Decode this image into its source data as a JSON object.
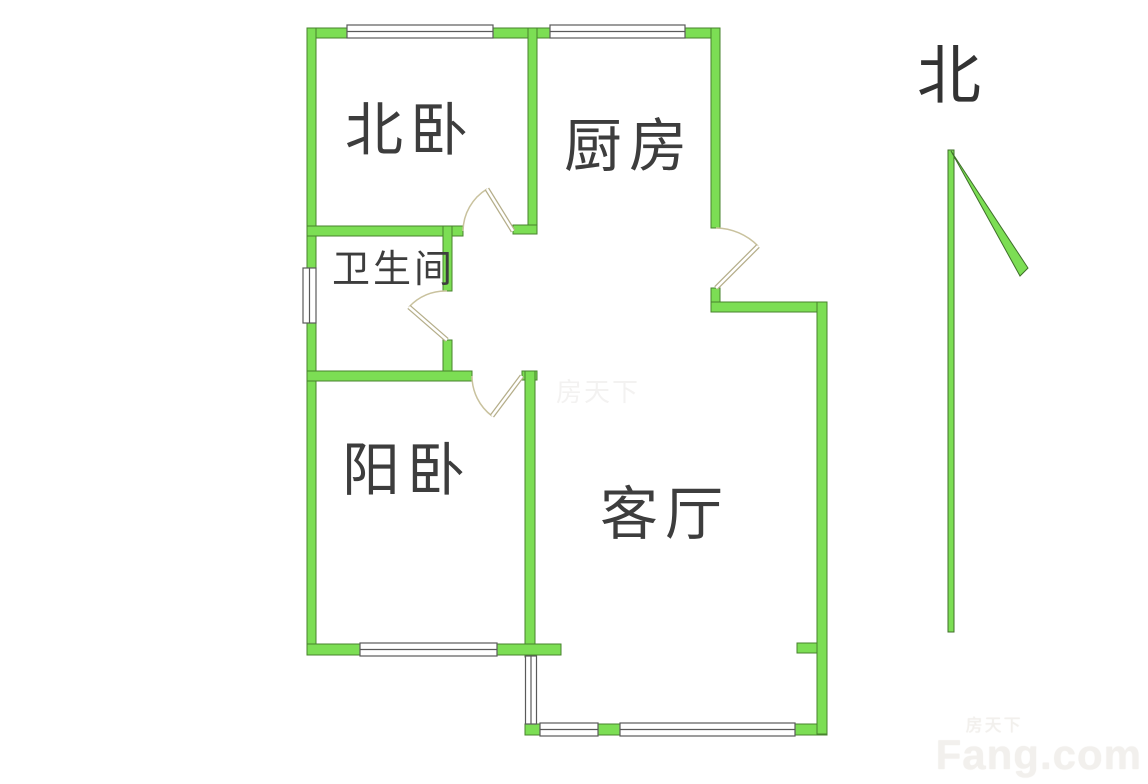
{
  "page": {
    "background": "#ffffff"
  },
  "colors": {
    "wall_fill": "#7CDE54",
    "wall_stroke": "#47832D",
    "window_fill": "#FFFFFF",
    "window_stroke": "#5A5A5A",
    "door_arc_stroke": "#C9C29E",
    "door_leaf_stroke": "#B5AE8A",
    "label_color": "#3D3D3D",
    "watermark_color": "#F2F0ED"
  },
  "rooms": [
    {
      "id": "north-bedroom",
      "label": "北卧"
    },
    {
      "id": "kitchen",
      "label": "厨房"
    },
    {
      "id": "bathroom",
      "label": "卫生间"
    },
    {
      "id": "sun-bedroom",
      "label": "阳卧"
    },
    {
      "id": "living-room",
      "label": "客厅"
    }
  ],
  "compass": {
    "label": "北"
  },
  "watermark": {
    "cn": "房天下",
    "en": "Fang.com"
  },
  "center_watermark": {
    "cn": "房天下"
  }
}
